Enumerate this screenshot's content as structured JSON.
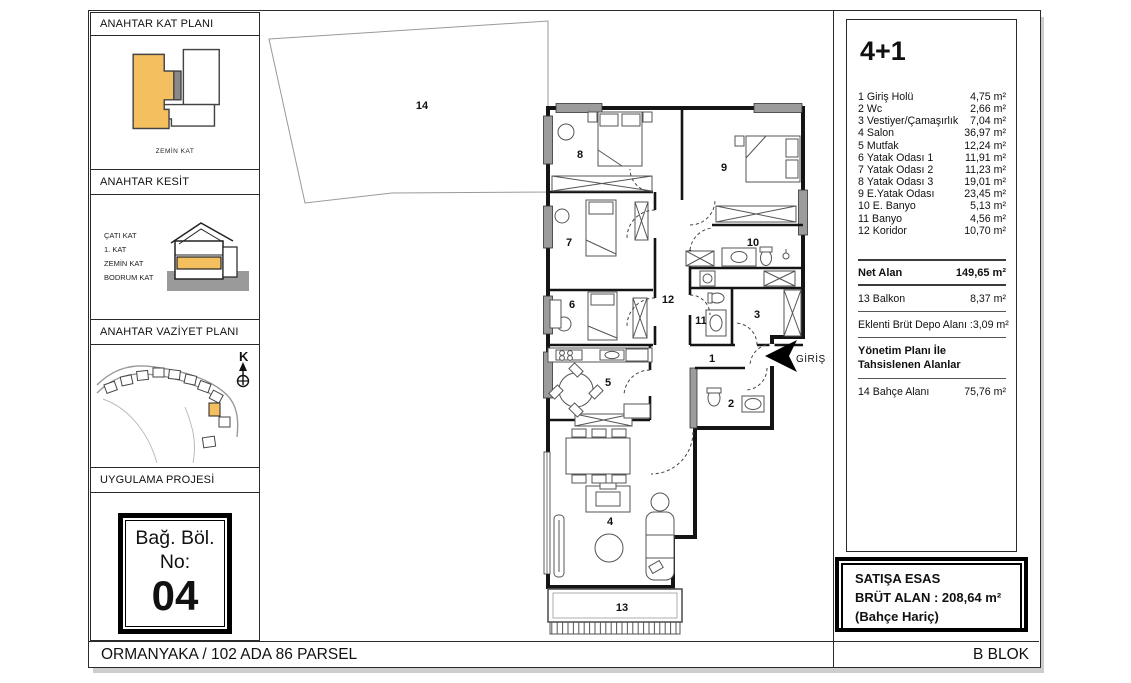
{
  "colors": {
    "highlight": "#F4C05F",
    "wall": "#1a1a1a",
    "window_gray": "#9c9c9c",
    "ground_gray": "#9a9a9a"
  },
  "sidebar": {
    "sections": [
      {
        "title": "ANAHTAR KAT PLANI"
      },
      {
        "title": "ANAHTAR KESİT"
      },
      {
        "title": "ANAHTAR VAZİYET PLANI"
      },
      {
        "title": "UYGULAMA PROJESİ"
      }
    ],
    "key_plan": {
      "caption": "ZEMİN KAT"
    },
    "key_section": {
      "labels": [
        "ÇATI KAT",
        "1. KAT",
        "ZEMİN KAT",
        "BODRUM KAT"
      ]
    },
    "site_plan": {
      "north_label": "K"
    },
    "unit_box": {
      "line1": "Bağ. Böl.",
      "line2": "No:",
      "number": "04"
    }
  },
  "plan": {
    "entrance_label": "GİRİŞ",
    "room_labels": [
      "1",
      "2",
      "3",
      "4",
      "5",
      "6",
      "7",
      "8",
      "9",
      "10",
      "11",
      "12",
      "13",
      "14"
    ]
  },
  "info_panel": {
    "title": "4+1",
    "rooms": [
      {
        "no": "1",
        "name": "Giriş Holü",
        "area": "4,75 m²"
      },
      {
        "no": "2",
        "name": "Wc",
        "area": "2,66 m²"
      },
      {
        "no": "3",
        "name": "Vestiyer/Çamaşırlık",
        "area": "7,04 m²"
      },
      {
        "no": "4",
        "name": "Salon",
        "area": "36,97 m²"
      },
      {
        "no": "5",
        "name": "Mutfak",
        "area": "12,24 m²"
      },
      {
        "no": "6",
        "name": "Yatak Odası 1",
        "area": "11,91 m²"
      },
      {
        "no": "7",
        "name": "Yatak Odası 2",
        "area": "11,23 m²"
      },
      {
        "no": "8",
        "name": "Yatak Odası 3",
        "area": "19,01 m²"
      },
      {
        "no": "9",
        "name": "E.Yatak Odası",
        "area": "23,45 m²"
      },
      {
        "no": "10",
        "name": "E. Banyo",
        "area": "5,13 m²"
      },
      {
        "no": "11",
        "name": "Banyo",
        "area": "4,56 m²"
      },
      {
        "no": "12",
        "name": "Koridor",
        "area": "10,70 m²"
      }
    ],
    "net_alan": {
      "label": "Net Alan",
      "value": "149,65 m²"
    },
    "balkon": {
      "no": "13",
      "name": "Balkon",
      "area": "8,37 m²"
    },
    "depo": {
      "label": "Eklenti Brüt Depo Alanı :",
      "value": "3,09 m²"
    },
    "yonetim_title": "Yönetim Planı İle Tahsislenen Alanlar",
    "bahce": {
      "no": "14",
      "name": "Bahçe Alanı",
      "area": "75,76 m²"
    }
  },
  "sales_box": {
    "line1": "SATIŞA ESAS",
    "line2": "BRÜT ALAN : 208,64 m²",
    "line3": "(Bahçe Hariç)"
  },
  "footer": {
    "left": "ORMANYAKA / 102 ADA 86 PARSEL",
    "right": "B BLOK"
  }
}
